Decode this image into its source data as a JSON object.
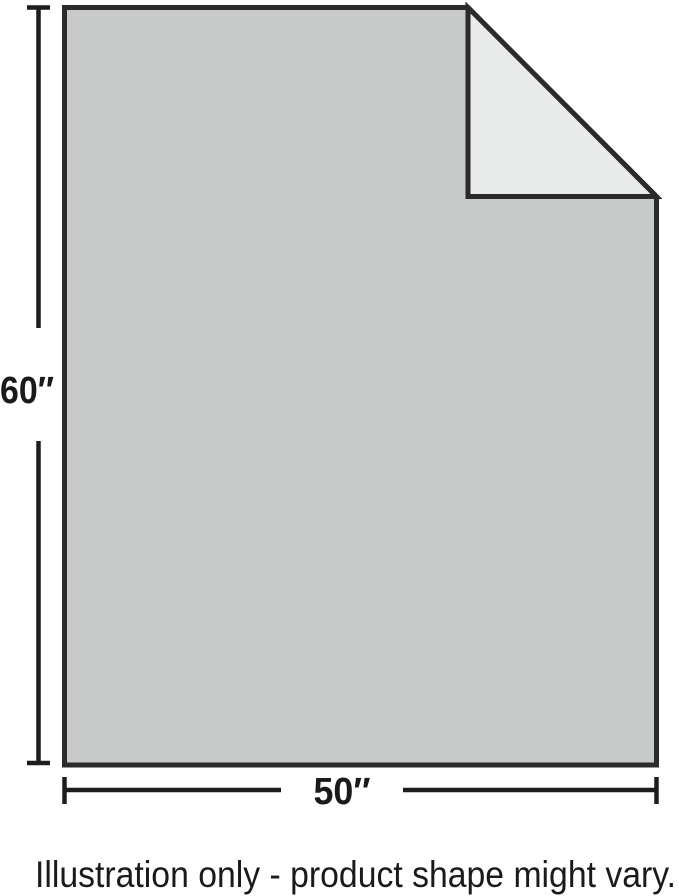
{
  "figure": {
    "type": "product-dimension-illustration",
    "height_label": "60″",
    "width_label": "50″",
    "caption": "Illustration only - product shape might vary.",
    "dimensions": {
      "height_inches": 60,
      "width_inches": 50
    },
    "colors": {
      "body_fill": "#c8caca",
      "fold_fill": "#e9eaea",
      "outline": "#2b2b2b",
      "dimension_lines": "#1d1d1d",
      "label_text": "#1a1a1a",
      "background": "#ffffff"
    }
  }
}
